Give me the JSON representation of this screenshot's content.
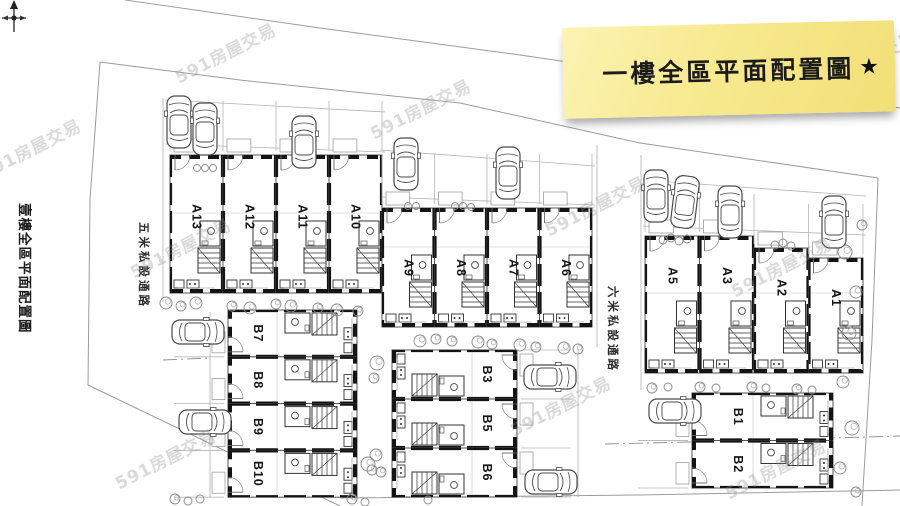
{
  "page": {
    "width": 900,
    "height": 506,
    "bg": "#ffffff"
  },
  "note": {
    "text": "一樓全區平面配置圖",
    "star": "★",
    "bg_light": "#fbf3b3",
    "bg_dark": "#f1df76"
  },
  "side_title": {
    "text": "壹樓全區平面配置圖"
  },
  "watermark": {
    "text": "591房屋交易",
    "color": "#8f8f8f",
    "positions": [
      [
        30,
        148
      ],
      [
        225,
        52
      ],
      [
        420,
        108
      ],
      [
        595,
        205
      ],
      [
        781,
        266
      ],
      [
        180,
        247
      ],
      [
        865,
        60
      ],
      [
        165,
        458
      ],
      [
        560,
        405
      ],
      [
        775,
        468
      ]
    ]
  },
  "roads": [
    {
      "id": "road-5m",
      "label": "五米私設通路",
      "x": 152,
      "y": 222
    },
    {
      "id": "road-6m",
      "label": "六米私設通路",
      "x": 621,
      "y": 286
    }
  ],
  "plan": {
    "wall_color": "#141414",
    "line_color": "#9c9c9c",
    "boundaries": [
      [
        [
          125,
          0
        ],
        [
          320,
          28
        ],
        [
          520,
          55
        ],
        [
          705,
          82
        ],
        [
          900,
          108
        ]
      ],
      [
        [
          100,
          62
        ],
        [
          240,
          80
        ],
        [
          460,
          103
        ],
        [
          640,
          143
        ],
        [
          878,
          178
        ]
      ],
      [
        [
          100,
          62
        ],
        [
          90,
          200
        ],
        [
          88,
          385
        ],
        [
          340,
          506
        ]
      ],
      [
        [
          878,
          178
        ],
        [
          872,
          340
        ],
        [
          862,
          506
        ]
      ],
      [
        [
          340,
          498
        ],
        [
          640,
          495
        ],
        [
          900,
          490
        ]
      ]
    ],
    "dashdot": [
      [
        [
          605,
          444
        ],
        [
          690,
          442
        ],
        [
          900,
          436
        ]
      ],
      [
        [
          163,
          360
        ],
        [
          210,
          358
        ]
      ]
    ],
    "road_lines": [
      [
        [
          163,
          98
        ],
        [
          163,
          302
        ]
      ],
      [
        [
          210,
          312
        ],
        [
          210,
          497
        ]
      ],
      [
        [
          597,
          145
        ],
        [
          597,
          347
        ]
      ],
      [
        [
          578,
          350
        ],
        [
          578,
          497
        ]
      ],
      [
        [
          641,
          155
        ],
        [
          641,
          390
        ]
      ],
      [
        [
          165,
          100
        ],
        [
          385,
          112
        ]
      ],
      [
        [
          380,
          150
        ],
        [
          595,
          166
        ]
      ],
      [
        [
          643,
          180
        ],
        [
          866,
          196
        ]
      ],
      [
        [
          165,
          144
        ],
        [
          385,
          152
        ]
      ],
      [
        [
          380,
          197
        ],
        [
          595,
          205
        ]
      ],
      [
        [
          643,
          226
        ],
        [
          866,
          235
        ]
      ]
    ],
    "blocks": [
      {
        "id": "A-left",
        "kind": "A",
        "x": 170,
        "unit_w": 53,
        "top": 155,
        "bottom": 293,
        "label_v": 62,
        "flip": false,
        "units": [
          {
            "label": "A13"
          },
          {
            "label": "A12"
          },
          {
            "label": "A11"
          },
          {
            "label": "A10"
          }
        ]
      },
      {
        "id": "A-mid",
        "kind": "A",
        "x": 382,
        "unit_w": 52.5,
        "top": 208,
        "bottom": 327,
        "label_v": 60,
        "flip": false,
        "units": [
          {
            "label": "A9"
          },
          {
            "label": "A8"
          },
          {
            "label": "A7"
          },
          {
            "label": "A6"
          }
        ]
      },
      {
        "id": "A-right",
        "kind": "A",
        "x": 645,
        "unit_w": 54.5,
        "top": 236,
        "bottom": 373,
        "label_v": 40,
        "flip": false,
        "units": [
          {
            "label": "A5",
            "top": 236
          },
          {
            "label": "A3",
            "top": 236
          },
          {
            "label": "A2",
            "top": 248
          },
          {
            "label": "A1",
            "top": 258
          }
        ]
      },
      {
        "id": "B-left",
        "kind": "B",
        "entry": "left",
        "x": 392,
        "left": 228,
        "depth": 129,
        "top": 310,
        "unit_h": 46.8,
        "label_v": 30,
        "flip": true,
        "units": [
          {
            "label": "B7"
          },
          {
            "label": "B8"
          },
          {
            "label": "B9"
          },
          {
            "label": "B10"
          }
        ]
      },
      {
        "id": "B-mid",
        "kind": "B",
        "entry": "right",
        "x": 392,
        "left": 392,
        "depth": 125,
        "top": 350,
        "unit_h": 49,
        "label_v": 30,
        "flip": false,
        "units": [
          {
            "label": "B3"
          },
          {
            "label": "B5"
          },
          {
            "label": "B6"
          }
        ]
      },
      {
        "id": "B-right",
        "kind": "B",
        "entry": "left",
        "x": 692,
        "left": 692,
        "depth": 141,
        "top": 393,
        "unit_h": 47.5,
        "label_v": 46,
        "flip": true,
        "units": [
          {
            "label": "B1"
          },
          {
            "label": "B2"
          }
        ]
      }
    ],
    "trees": [
      [
        197,
        168,
        3.5
      ],
      [
        205,
        168,
        3.5
      ],
      [
        213,
        168,
        3.5
      ],
      [
        408,
        206,
        3.5
      ],
      [
        416,
        206,
        3.5
      ],
      [
        455,
        206,
        3.5
      ],
      [
        463,
        206,
        3.5
      ],
      [
        471,
        207,
        3.5
      ],
      [
        663,
        240,
        4
      ],
      [
        671,
        238,
        4
      ],
      [
        679,
        241,
        4
      ],
      [
        687,
        239,
        4
      ],
      [
        775,
        245,
        4
      ],
      [
        783,
        243,
        4
      ],
      [
        791,
        246,
        4
      ],
      [
        166,
        303,
        6
      ],
      [
        181,
        306,
        5
      ],
      [
        196,
        303,
        6
      ],
      [
        232,
        306,
        5
      ],
      [
        250,
        308,
        6
      ],
      [
        276,
        304,
        5
      ],
      [
        291,
        306,
        6
      ],
      [
        318,
        308,
        5
      ],
      [
        337,
        310,
        6
      ],
      [
        358,
        311,
        5
      ],
      [
        420,
        341,
        6
      ],
      [
        436,
        339,
        5
      ],
      [
        452,
        341,
        5
      ],
      [
        478,
        342,
        6
      ],
      [
        492,
        344,
        5
      ],
      [
        520,
        345,
        6
      ],
      [
        536,
        347,
        5
      ],
      [
        564,
        348,
        6
      ],
      [
        578,
        349,
        5
      ],
      [
        652,
        388,
        5
      ],
      [
        668,
        387,
        4
      ],
      [
        700,
        387,
        5
      ],
      [
        716,
        388,
        4
      ],
      [
        752,
        387,
        5
      ],
      [
        766,
        388,
        4
      ],
      [
        797,
        389,
        5
      ],
      [
        812,
        390,
        4
      ],
      [
        862,
        225,
        5
      ],
      [
        845,
        252,
        7
      ],
      [
        856,
        292,
        6
      ],
      [
        849,
        333,
        7
      ],
      [
        843,
        382,
        6
      ],
      [
        852,
        428,
        7
      ],
      [
        840,
        468,
        6
      ],
      [
        856,
        492,
        5
      ],
      [
        377,
        363,
        7
      ],
      [
        374,
        378,
        5
      ],
      [
        376,
        455,
        6
      ],
      [
        372,
        470,
        5
      ],
      [
        368,
        464,
        7
      ],
      [
        381,
        472,
        5
      ],
      [
        175,
        499,
        5
      ],
      [
        188,
        501,
        4
      ],
      [
        200,
        499,
        4
      ],
      [
        352,
        499,
        5
      ],
      [
        365,
        502,
        4
      ],
      [
        428,
        500,
        4
      ]
    ],
    "cars": [
      [
        179,
        122,
        0
      ],
      [
        205,
        129,
        0
      ],
      [
        304,
        142,
        0
      ],
      [
        406,
        164,
        0
      ],
      [
        508,
        173,
        0
      ],
      [
        656,
        196,
        0
      ],
      [
        685,
        202,
        7
      ],
      [
        730,
        212,
        0
      ],
      [
        834,
        222,
        0
      ],
      [
        198,
        332,
        90
      ],
      [
        205,
        422,
        90
      ],
      [
        550,
        377,
        90
      ],
      [
        551,
        482,
        90
      ],
      [
        675,
        411,
        90
      ]
    ]
  }
}
